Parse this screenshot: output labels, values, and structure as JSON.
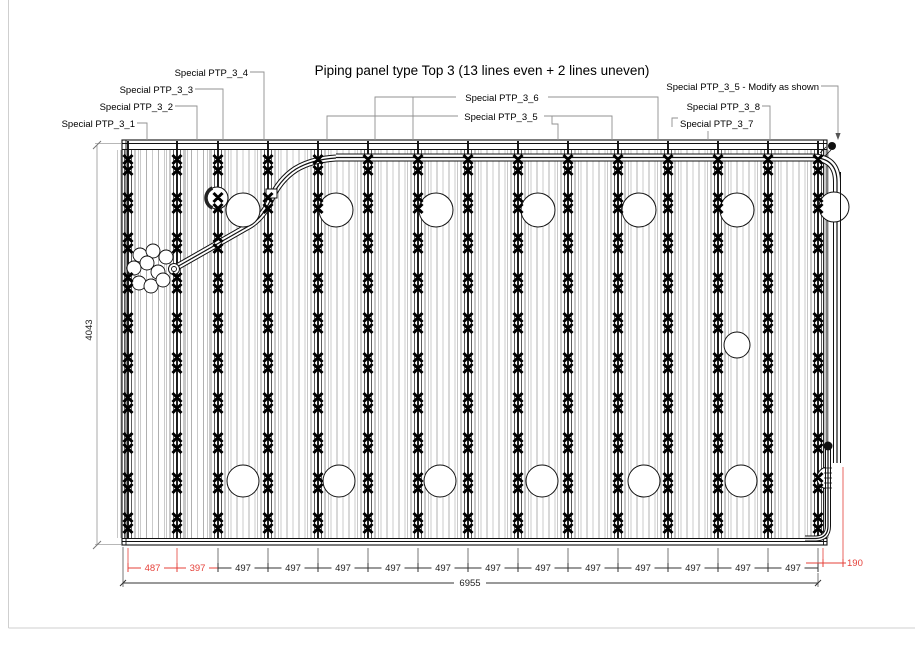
{
  "title": {
    "text": "Piping panel type Top 3 (13 lines even + 2 lines uneven)"
  },
  "colors": {
    "ink": "#111111",
    "red": "#e5413a",
    "leader": "#909090",
    "dim_dark": "#333333",
    "dim_gray": "#6f6f6f",
    "side_dim": "#a0a0a0",
    "frame": "#cfcfcf",
    "line_main": "#101010",
    "line_near": "#4a4a4a",
    "line_mid": "#8a8a8a",
    "line_far": "#c2c2c2",
    "fill_a": "#c6c6c6",
    "fill_b": "#a8a8a8"
  },
  "callouts": [
    {
      "label": "Special PTP_3_1",
      "tx": 135,
      "ty": 127,
      "anchor": "end",
      "leaders": [
        "M137,123 H147 V140"
      ]
    },
    {
      "label": "Special PTP_3_2",
      "tx": 173,
      "ty": 110,
      "anchor": "end",
      "leaders": [
        "M175,106 H197 V140"
      ]
    },
    {
      "label": "Special PTP_3_3",
      "tx": 193,
      "ty": 93,
      "anchor": "end",
      "leaders": [
        "M195,89 H223 V140"
      ]
    },
    {
      "label": "Special PTP_3_4",
      "tx": 248,
      "ty": 76,
      "anchor": "end",
      "leaders": [
        "M250,72 H264 V140"
      ]
    },
    {
      "label": "Special PTP_3_6",
      "tx": 502,
      "ty": 101,
      "anchor": "middle",
      "leaders": [
        "M456,97 H375 V140",
        "M548,97 H658 V140",
        "M413,97 V140"
      ]
    },
    {
      "label": "Special PTP_3_5",
      "tx": 501,
      "ty": 120,
      "anchor": "middle",
      "leaders": [
        "M458,116 H327 V140",
        "M544,116 H612 V140",
        "M552,116 V124 H558 V140"
      ]
    },
    {
      "label": "Special PTP_3_5 - Modify as shown",
      "tx": 819,
      "ty": 90,
      "anchor": "end",
      "leaders": [
        "M821,86 H838 V134"
      ],
      "arrow": [
        838,
        140
      ]
    },
    {
      "label": "Special PTP_3_8",
      "tx": 760,
      "ty": 110,
      "anchor": "end",
      "leaders": [
        "M762,106 H770 V140"
      ]
    },
    {
      "label": "Special PTP_3_7",
      "tx": 680,
      "ty": 127,
      "anchor": "start",
      "leaders": [
        "M678,118 H672 V127",
        "M708,131 V140"
      ]
    }
  ],
  "panel": {
    "frame": {
      "x": 122,
      "y": 140,
      "w": 705,
      "h": 405
    },
    "lines_x": [
      128,
      177,
      218,
      268,
      318,
      368,
      418,
      468,
      518,
      568,
      618,
      668,
      718,
      768,
      818
    ],
    "clip_rows_y": [
      165,
      203,
      243,
      283,
      323,
      363,
      403,
      443,
      483,
      523
    ],
    "holes_top": {
      "y": 210,
      "r": 17,
      "xs": [
        243,
        336,
        436,
        538,
        639,
        737
      ]
    },
    "holes_bottom": {
      "y": 481,
      "r": 16,
      "xs": [
        243,
        339,
        440,
        542,
        644,
        741
      ]
    },
    "hole_single": {
      "x": 737,
      "y": 345,
      "r": 13
    },
    "edge_circle_top": {
      "x": 834,
      "y": 207,
      "r": 15
    },
    "edge_bump": {
      "x": 828,
      "y1": 467,
      "y2": 489,
      "r": 11
    },
    "clamp_circle": {
      "x": 217,
      "y": 198,
      "r": 11
    },
    "cluster_circles": {
      "r": 7,
      "centers": [
        [
          140,
          255
        ],
        [
          153,
          251
        ],
        [
          166,
          257
        ],
        [
          134,
          268
        ],
        [
          147,
          263
        ],
        [
          158,
          272
        ],
        [
          139,
          283
        ],
        [
          151,
          286
        ],
        [
          163,
          280
        ]
      ]
    },
    "fitting_end": {
      "x": 174,
      "y": 269,
      "r_outer": 5.5,
      "r_inner": 2.5
    },
    "fitting_square": {
      "x": 266,
      "y": 189,
      "w": 11,
      "h": 9
    }
  },
  "pipes": {
    "top_run": "M336,157.5 H812 Q837,157.5 837,182 V463",
    "s_curve": "M175,268 L247,227 Q262,219 270,201 Q279,180 296,169 Q312,159.5 336,158",
    "right_drop": "M828,446 V526 Q828,538 816,538.5 H805",
    "outer_redraw": "M840.5,172 V463",
    "balls": [
      [
        832,
        146,
        4
      ],
      [
        828,
        446,
        4.5
      ]
    ],
    "hatches": [
      "M820,153 L826,147",
      "M825,156 L831,150",
      "M824,468 H832",
      "M824,473 H832",
      "M824,478 H832",
      "M824,483 H832",
      "M824,488 H832"
    ]
  },
  "dimensions": {
    "bottom": {
      "y": 568,
      "labels": [
        {
          "v": "487",
          "c": "red",
          "cx": 152.5
        },
        {
          "v": "397",
          "c": "red",
          "cx": 197.5
        },
        {
          "v": "497",
          "cx": 243
        },
        {
          "v": "497",
          "cx": 293
        },
        {
          "v": "497",
          "cx": 343
        },
        {
          "v": "497",
          "cx": 393
        },
        {
          "v": "497",
          "cx": 443
        },
        {
          "v": "497",
          "cx": 493
        },
        {
          "v": "497",
          "cx": 543
        },
        {
          "v": "497",
          "cx": 593
        },
        {
          "v": "497",
          "cx": 643
        },
        {
          "v": "497",
          "cx": 693
        },
        {
          "v": "497",
          "cx": 743
        },
        {
          "v": "497",
          "cx": 793
        }
      ]
    },
    "total": {
      "value": "6955",
      "y": 583,
      "x1": 123,
      "x2": 818,
      "tcx": 470
    },
    "side": {
      "value": "4043",
      "x": 97,
      "y1": 145,
      "y2": 545,
      "tcy": 330
    },
    "right": {
      "value": "190",
      "y": 563,
      "x1": 823,
      "x2": 843,
      "tail_x": 806
    }
  }
}
